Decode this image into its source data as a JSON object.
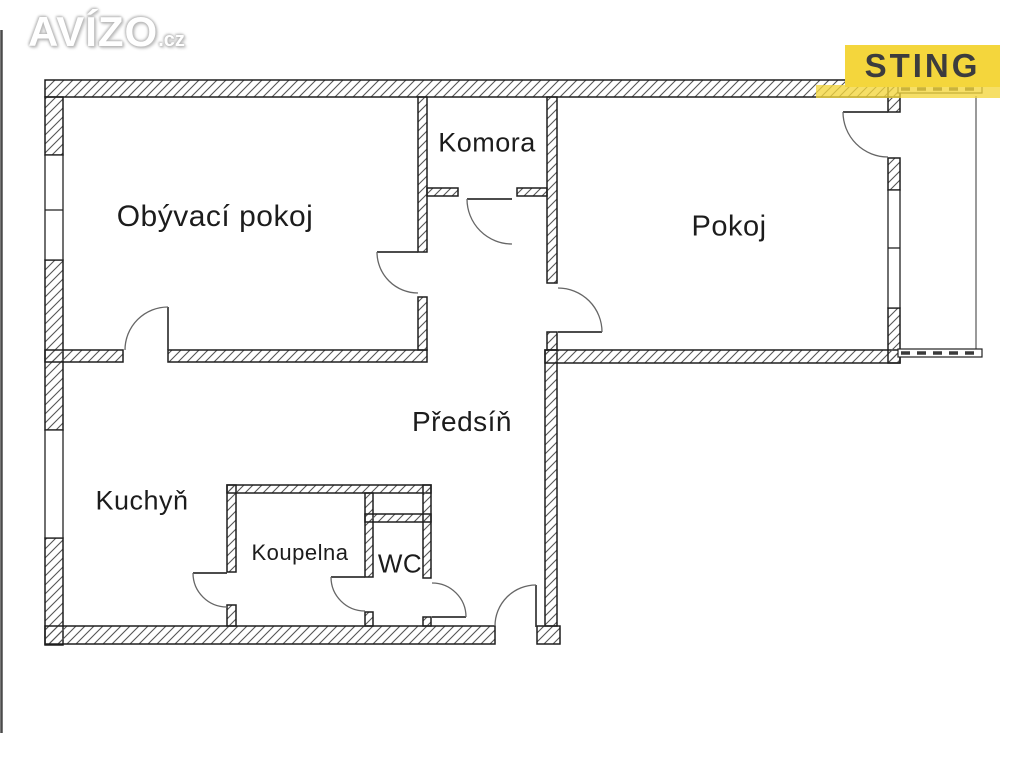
{
  "branding": {
    "avizo": {
      "text": "AVÍZO",
      "suffix": ".cz"
    },
    "sting": {
      "text": "STING",
      "bg_color": "#f4d63c",
      "fg_color": "#3c3c3e"
    }
  },
  "floorplan": {
    "type": "apartment-floor-plan",
    "rooms": [
      {
        "id": "obyvaci-pokoj",
        "label": "Obývací pokoj"
      },
      {
        "id": "komora",
        "label": "Komora"
      },
      {
        "id": "pokoj",
        "label": "Pokoj"
      },
      {
        "id": "predsin",
        "label": "Předsíň"
      },
      {
        "id": "kuchyn",
        "label": "Kuchyň"
      },
      {
        "id": "koupelna",
        "label": "Koupelna"
      },
      {
        "id": "wc",
        "label": "WC"
      }
    ],
    "colors": {
      "wall_outline": "#1f1f1f",
      "hatch_line": "#555555",
      "door_arc": "#666666",
      "label_text": "#1c1c1c"
    }
  }
}
